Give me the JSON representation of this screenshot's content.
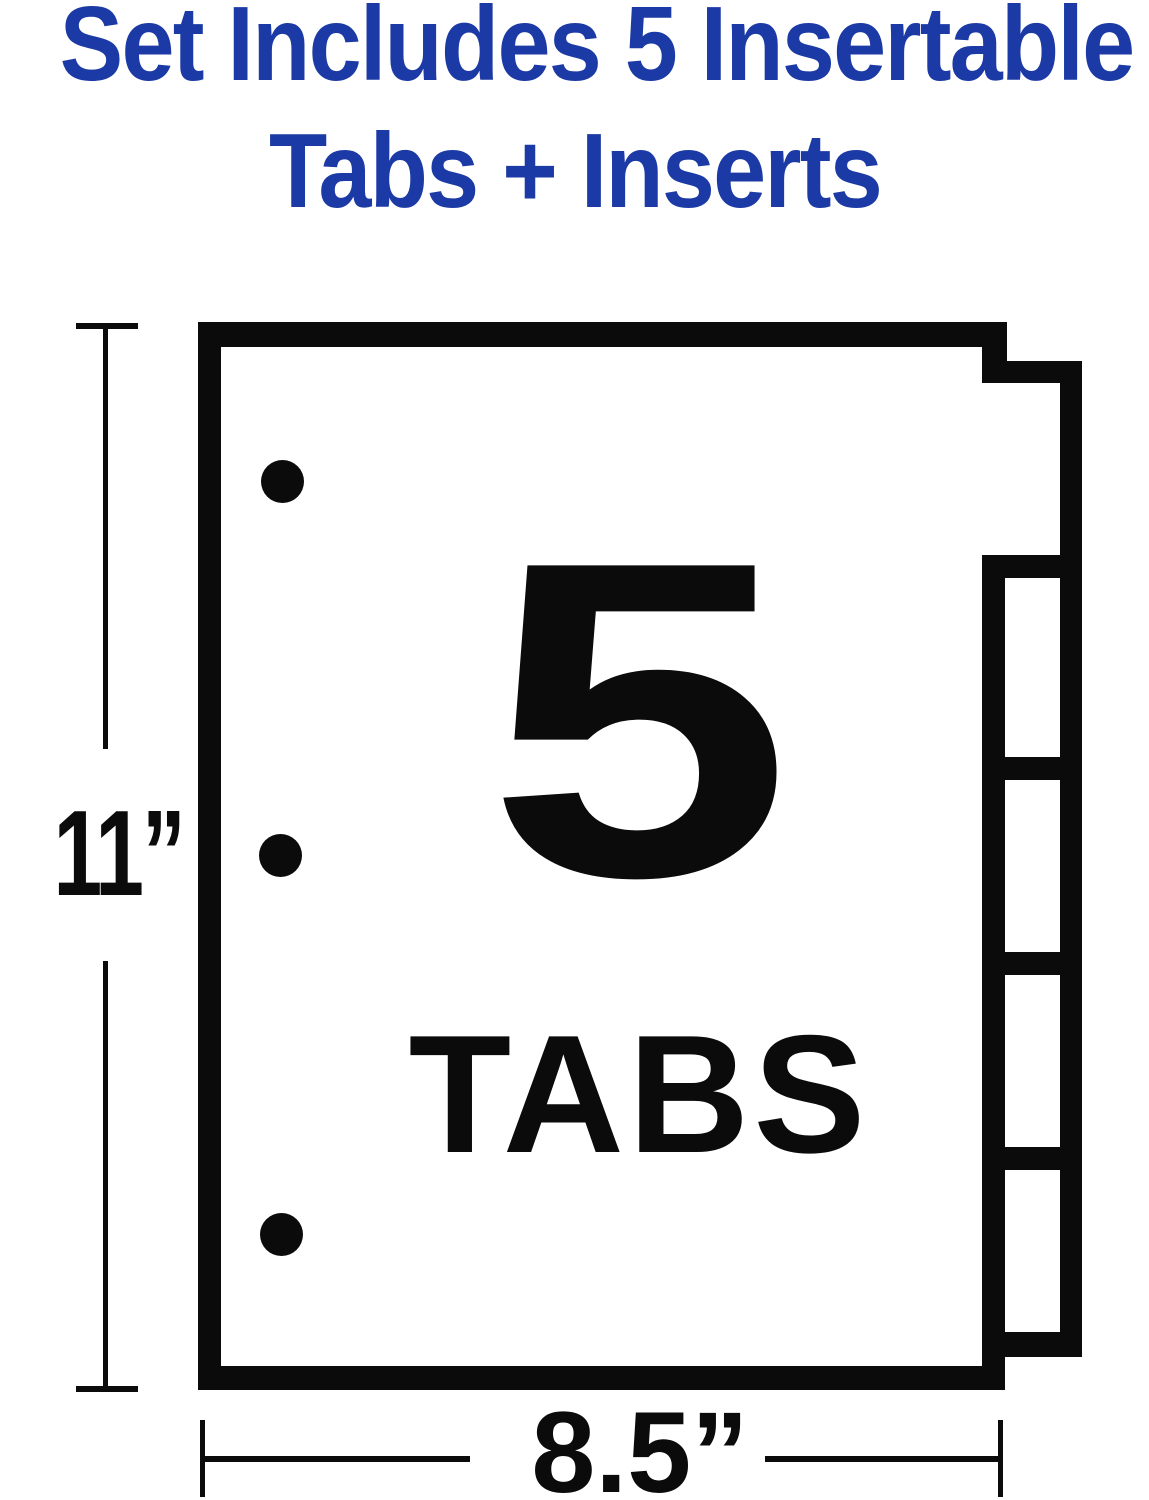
{
  "title": {
    "line1": "Set Includes 5 Insertable",
    "line2": "Tabs + Inserts",
    "color": "#1c3aa5"
  },
  "diagram": {
    "ink_color": "#0b0b0b",
    "background": "#ffffff",
    "tab_count_number": "5",
    "tab_count_label": "TABS",
    "height_dimension_label": "11”",
    "width_dimension_label": "8.5”",
    "num_tabs_shown": 5,
    "num_punch_holes": 3
  }
}
